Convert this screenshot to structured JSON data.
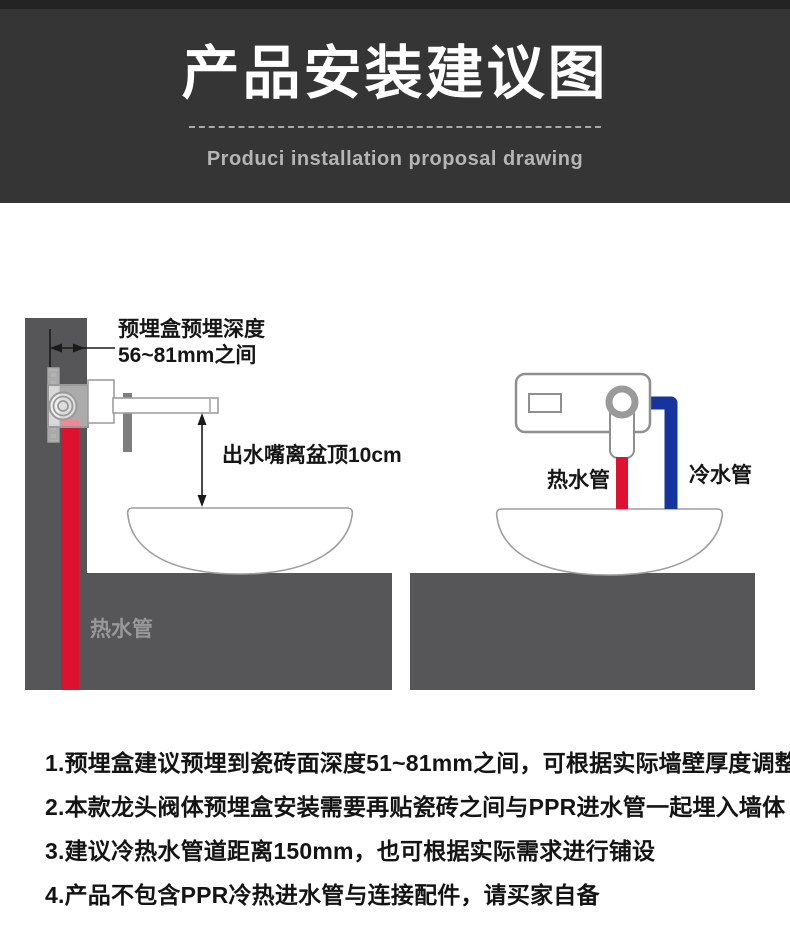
{
  "header": {
    "title": "产品安装建议图",
    "subtitle": "Produci installation proposal drawing"
  },
  "diagram": {
    "left": {
      "depth_label_line1": "预埋盒预埋深度",
      "depth_label_line2": "56~81mm之间",
      "spout_height_label": "出水嘴离盆顶10cm",
      "hot_pipe_label": "热水管"
    },
    "right": {
      "hot_pipe_label": "热水管",
      "cold_pipe_label": "冷水管"
    },
    "colors": {
      "hot_pipe": "#de1130",
      "cold_pipe": "#16349e",
      "concrete": "#565658",
      "outline": "#9a9a9a"
    }
  },
  "notes": [
    "1.预埋盒建议预埋到瓷砖面深度51~81mm之间，可根据实际墙壁厚度调整",
    "2.本款龙头阀体预埋盒安装需要再贴瓷砖之间与PPR进水管一起埋入墙体",
    "3.建议冷热水管道距离150mm，也可根据实际需求进行铺设",
    "4.产品不包含PPR冷热进水管与连接配件，请买家自备"
  ]
}
